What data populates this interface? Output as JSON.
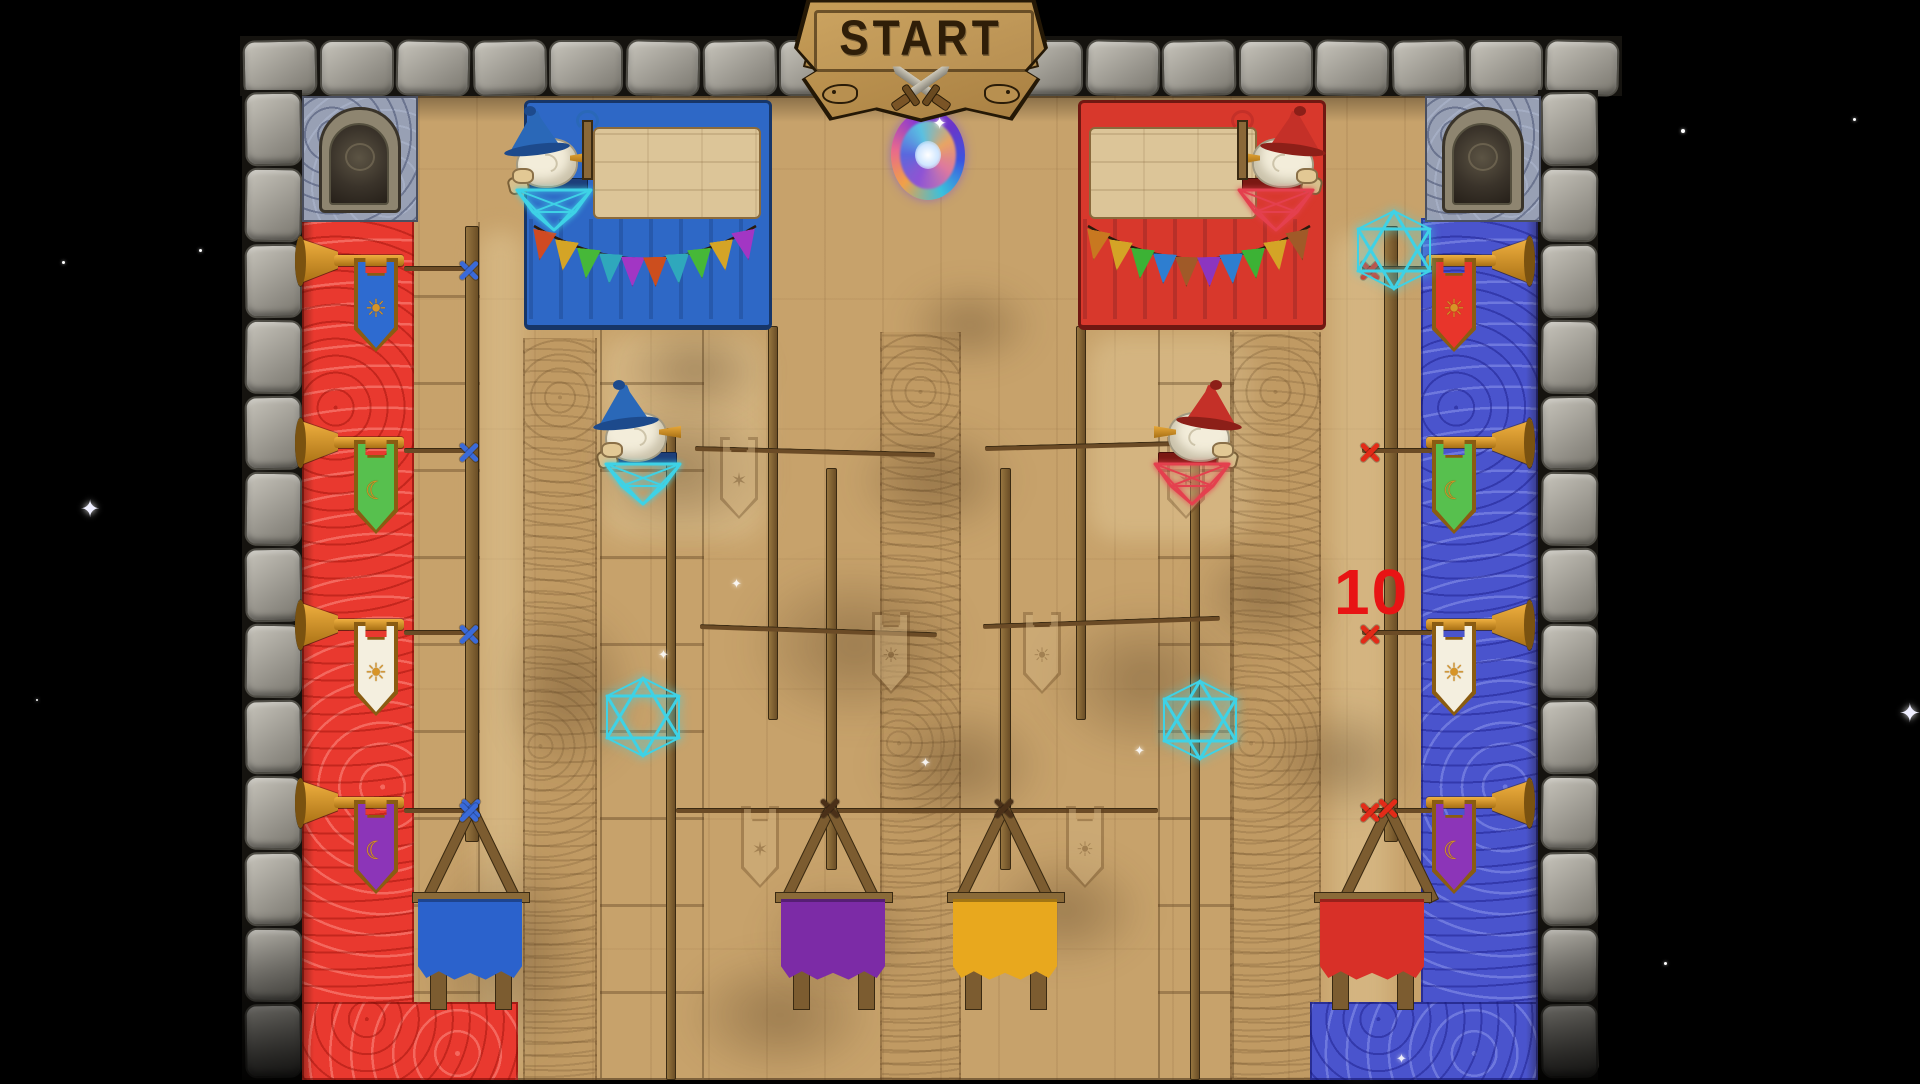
{
  "sign": {
    "label": "START"
  },
  "marker": {
    "value": "10",
    "color": "#e81414"
  },
  "glyphs": {
    "sun": "☀",
    "crescent": "☾",
    "star": "✶",
    "sparkle": "✦"
  },
  "colors": {
    "space": "#000000",
    "wood": "#c7a26b",
    "red_carpet": "#e9392f",
    "blue_carpet": "#4a54cd",
    "gold": "#d79427",
    "gold_dark": "#8a5c12",
    "parchment": "#dcc598",
    "marker_blue": "#3a6ad8",
    "marker_red": "#e22b18",
    "bind_dark": "#4a3018",
    "rope": "#6b4b26"
  },
  "teams": {
    "blue": {
      "hat": "#2a68b8",
      "hat_dark": "#1d4a8c",
      "web": "#3ed2e6",
      "seat": "#1d3f7a"
    },
    "red": {
      "hat": "#c43028",
      "hat_dark": "#8c1f18",
      "web": "#e4404e",
      "seat": "#7a1812"
    }
  },
  "left_banners": [
    {
      "color": "#2e6bd0",
      "symbol": "sun"
    },
    {
      "color": "#57c04e",
      "symbol": "crescent"
    },
    {
      "color": "#f4efdf",
      "symbol": "sun"
    },
    {
      "color": "#8c35b8",
      "symbol": "crescent"
    }
  ],
  "right_banners": [
    {
      "color": "#e8352b",
      "symbol": "sun"
    },
    {
      "color": "#57c04e",
      "symbol": "crescent"
    },
    {
      "color": "#f4efdf",
      "symbol": "sun"
    },
    {
      "color": "#8c35b8",
      "symbol": "crescent"
    }
  ],
  "base_bunting": {
    "blue": [
      "#d04a22",
      "#d4a426",
      "#46b838",
      "#2fa8bc",
      "#a236c4",
      "#cc4e1e",
      "#2fa8bc",
      "#46b838",
      "#d4a426",
      "#a236c4"
    ],
    "red": [
      "#c87820",
      "#d4a426",
      "#3cb235",
      "#2e7ed0",
      "#a05a28",
      "#8c35c0",
      "#2e7ed0",
      "#3cb235",
      "#d4a426",
      "#a05a28"
    ]
  },
  "buckets": [
    {
      "name": "blue",
      "color": "#2b62cc"
    },
    {
      "name": "purple",
      "color": "#7c2ba6"
    },
    {
      "name": "gold",
      "color": "#e8a81e"
    },
    {
      "name": "red",
      "color": "#d83028"
    }
  ],
  "sketch_symbols": [
    "star",
    "star",
    "sun",
    "sun",
    "star",
    "sun"
  ],
  "decor": {
    "stars": [
      {
        "x": 62,
        "y": 261,
        "s": 3
      },
      {
        "x": 199,
        "y": 249,
        "s": 3
      },
      {
        "x": 80,
        "y": 498,
        "s": 24,
        "big": true
      },
      {
        "x": 1681,
        "y": 129,
        "s": 4
      },
      {
        "x": 1853,
        "y": 118,
        "s": 3
      },
      {
        "x": 1899,
        "y": 700,
        "s": 26,
        "big": true
      },
      {
        "x": 1664,
        "y": 962,
        "s": 3
      },
      {
        "x": 36,
        "y": 699,
        "s": 2
      }
    ],
    "sparkles": [
      {
        "x": 658,
        "y": 648
      },
      {
        "x": 731,
        "y": 577
      },
      {
        "x": 1134,
        "y": 744
      },
      {
        "x": 1396,
        "y": 1052
      },
      {
        "x": 920,
        "y": 756
      }
    ]
  }
}
